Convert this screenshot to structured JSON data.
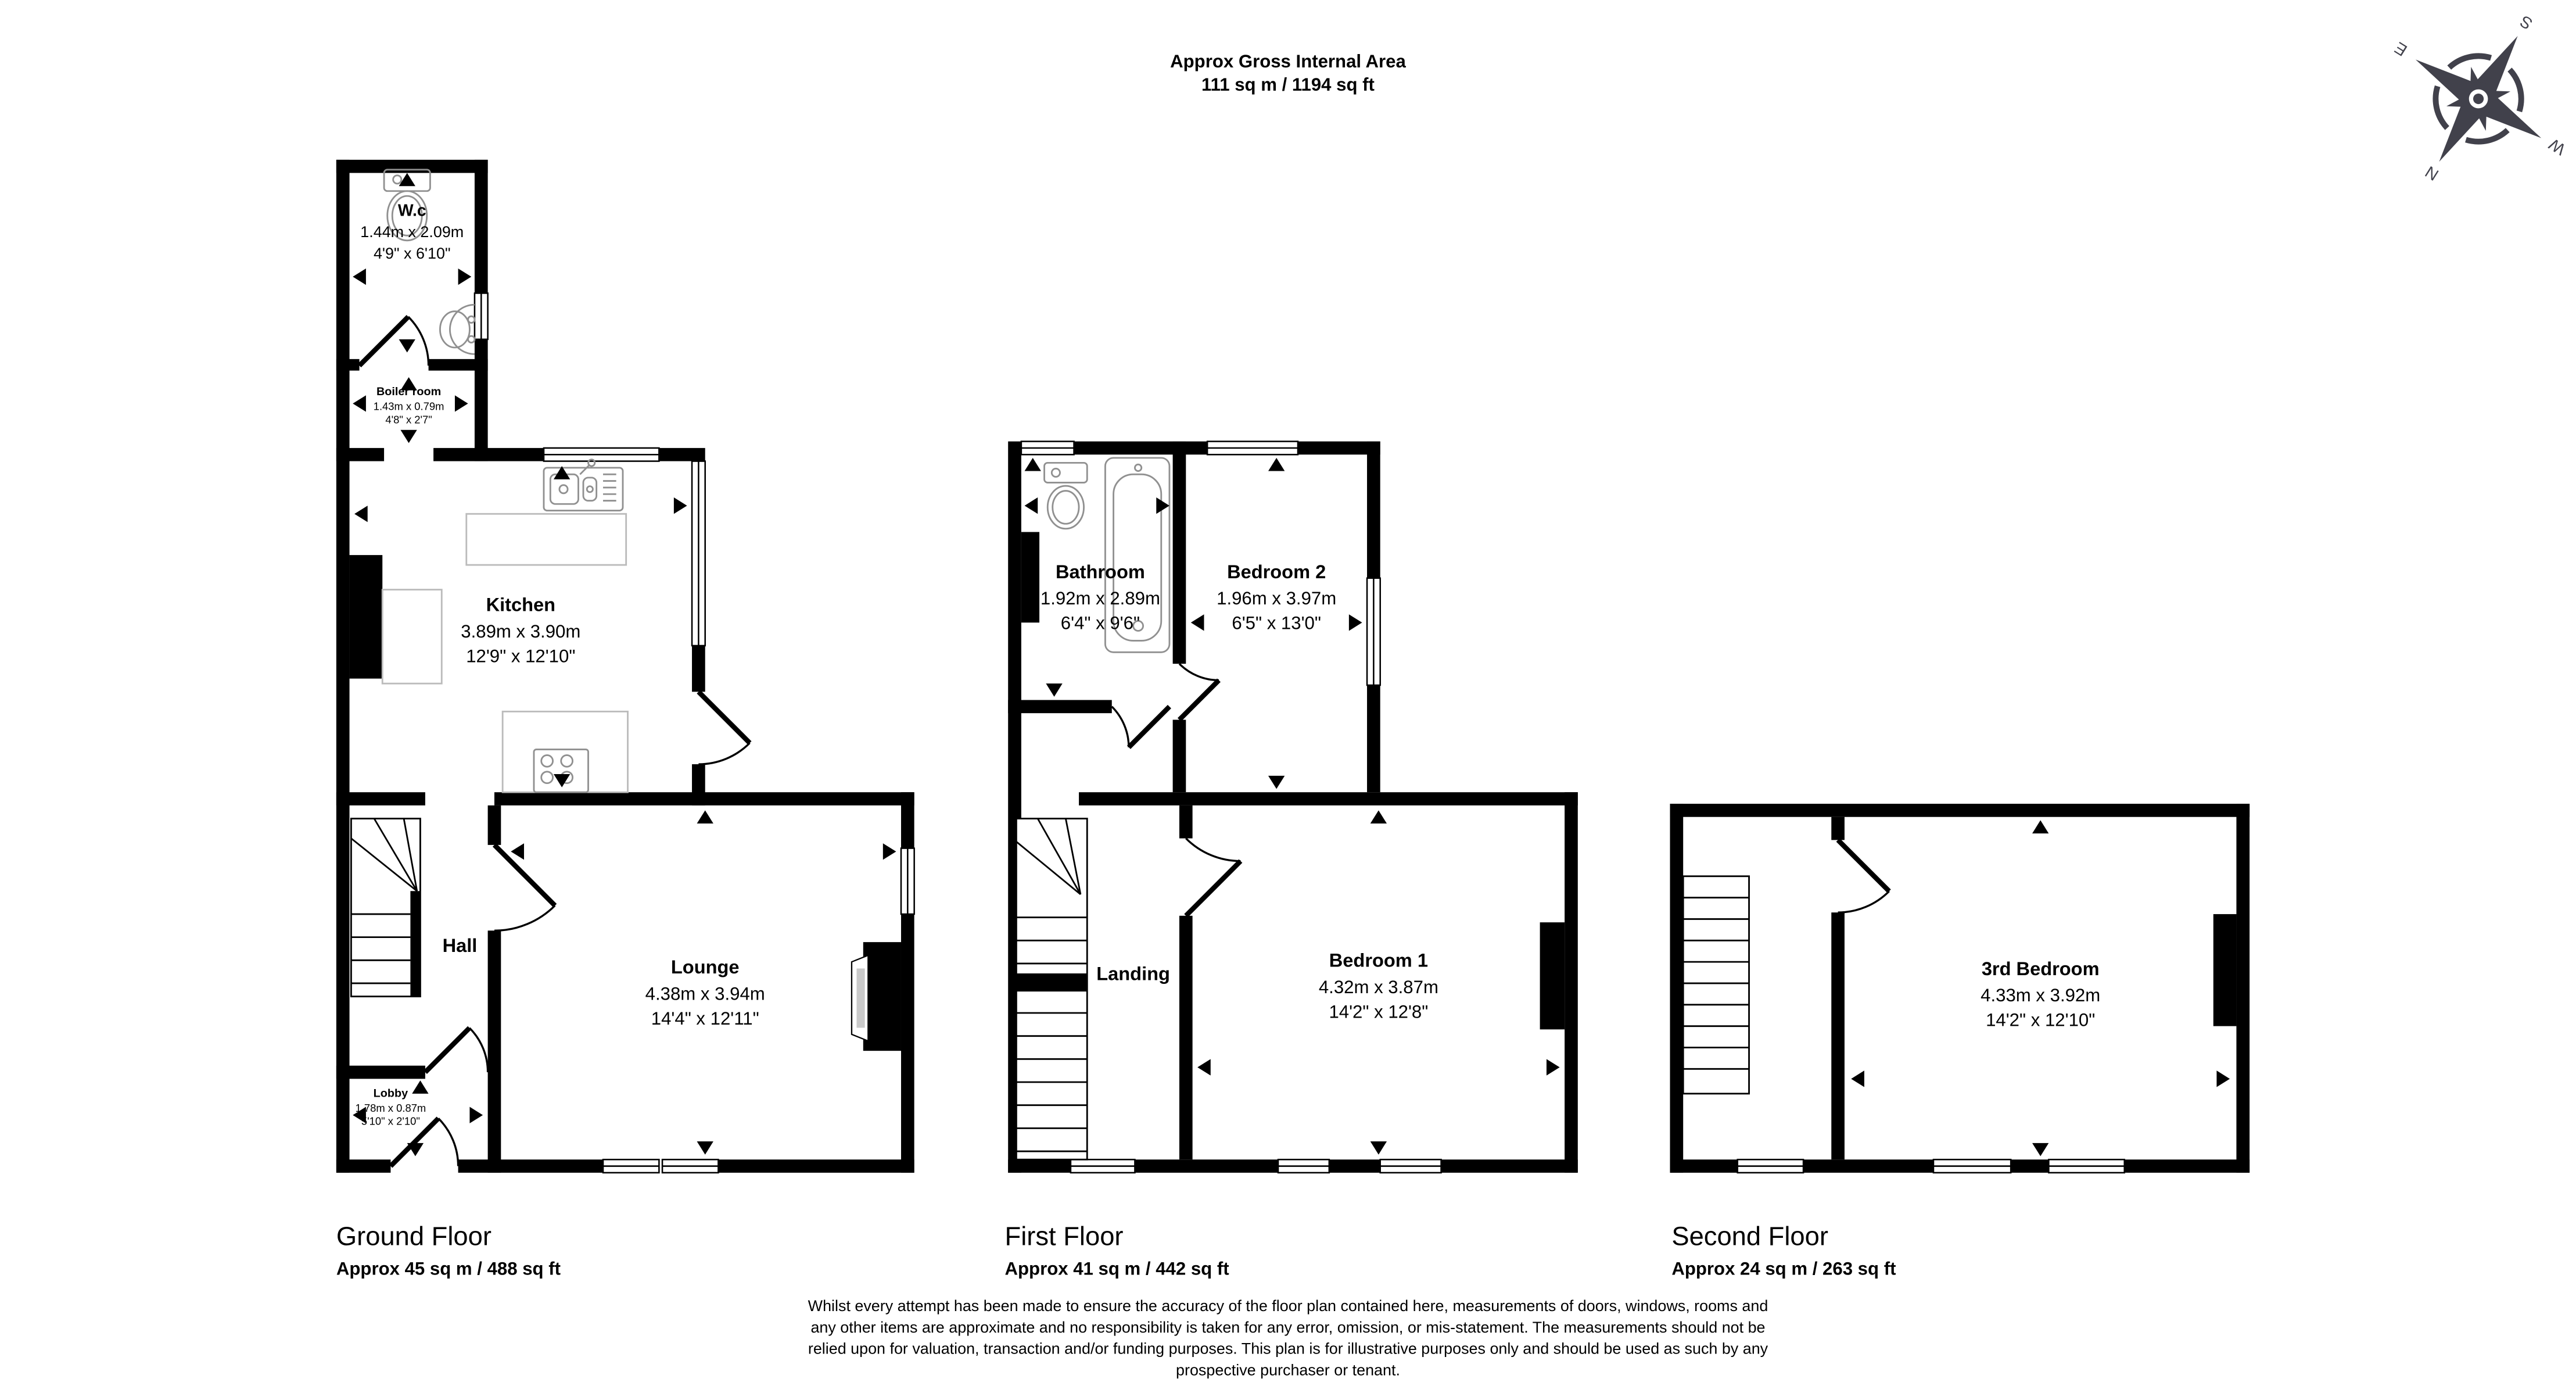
{
  "header": {
    "line1": "Approx Gross Internal Area",
    "line2": "111 sq m / 1194 sq ft"
  },
  "compass": {
    "north": "N",
    "east": "E",
    "south": "S",
    "west": "W"
  },
  "floors": {
    "ground": {
      "label": "Ground Floor",
      "area": "Approx 45 sq m / 488 sq ft",
      "rooms": {
        "wc": {
          "name": "W.c",
          "metric": "1.44m x 2.09m",
          "imperial": "4'9\" x 6'10\""
        },
        "boiler": {
          "name": "Boiler room",
          "metric": "1.43m x 0.79m",
          "imperial": "4'8\" x 2'7\""
        },
        "kitchen": {
          "name": "Kitchen",
          "metric": "3.89m x 3.90m",
          "imperial": "12'9\" x 12'10\""
        },
        "hall": {
          "name": "Hall"
        },
        "lounge": {
          "name": "Lounge",
          "metric": "4.38m x 3.94m",
          "imperial": "14'4\" x 12'11\""
        },
        "lobby": {
          "name": "Lobby",
          "metric": "1.78m x 0.87m",
          "imperial": "5'10\" x 2'10\""
        }
      }
    },
    "first": {
      "label": "First Floor",
      "area": "Approx 41 sq m / 442 sq ft",
      "rooms": {
        "bathroom": {
          "name": "Bathroom",
          "metric": "1.92m x 2.89m",
          "imperial": "6'4\" x 9'6\""
        },
        "bedroom2": {
          "name": "Bedroom 2",
          "metric": "1.96m x 3.97m",
          "imperial": "6'5\" x 13'0\""
        },
        "landing": {
          "name": "Landing"
        },
        "bedroom1": {
          "name": "Bedroom 1",
          "metric": "4.32m x 3.87m",
          "imperial": "14'2\" x 12'8\""
        }
      }
    },
    "second": {
      "label": "Second Floor",
      "area": "Approx 24 sq m / 263 sq ft",
      "rooms": {
        "bedroom3": {
          "name": "3rd Bedroom",
          "metric": "4.33m x 3.92m",
          "imperial": "14'2\" x 12'10\""
        }
      }
    }
  },
  "disclaimer": {
    "line1": "Whilst every attempt has been made to ensure the accuracy of the floor plan contained here, measurements of doors, windows, rooms and",
    "line2": "any other items are approximate and no responsibility is taken for any error, omission, or mis-statement. The measurements should not be",
    "line3": "relied upon for valuation, transaction and/or funding purposes. This plan is for illustrative purposes only and should be used as such by any",
    "line4": "prospective purchaser or tenant."
  }
}
